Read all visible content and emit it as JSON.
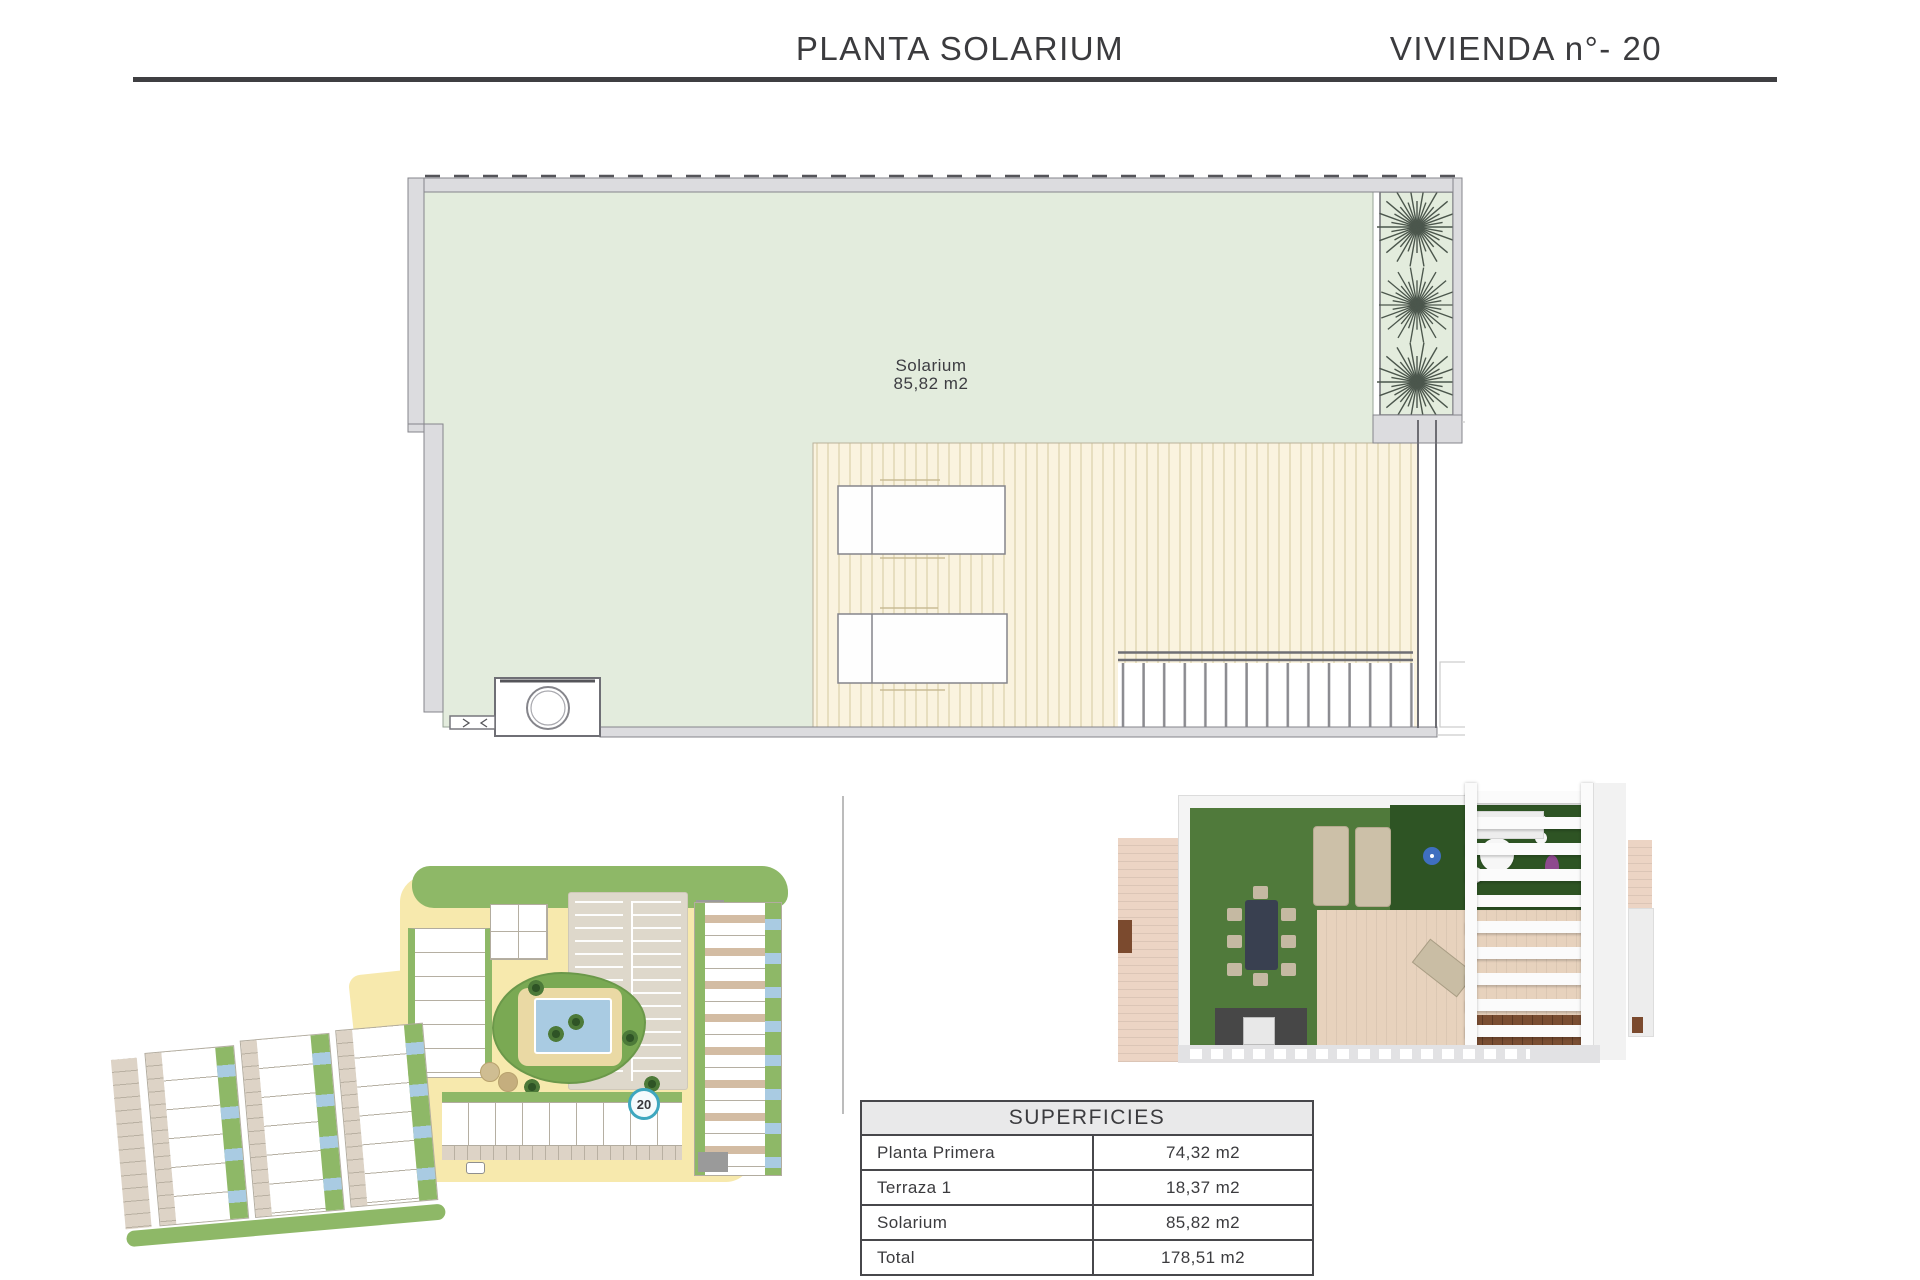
{
  "header": {
    "title_left": "PLANTA SOLARIUM",
    "title_right": "VIVIENDA n°- 20",
    "rule_color": "#3f3f42"
  },
  "floor_plan": {
    "room_label": {
      "name": "Solarium",
      "area": "85,82 m2"
    },
    "colors": {
      "solarium_green": "#e3ecdd",
      "deck_cream": "#faf3df",
      "deck_stripe": "#d9cfae",
      "wall_gray": "#dcdcdf"
    }
  },
  "site_plan": {
    "unit_marker": "20",
    "colors": {
      "road_yellow": "#f7e9ad",
      "grass_green": "#8eb867",
      "garden_green": "#7aa953",
      "pool_blue": "#a9cbe2",
      "paving": "#ded8cb",
      "marker_ring": "#3ea7bf"
    }
  },
  "render_3d": {
    "colors": {
      "turf": "#507a3b",
      "turf_dark": "#2e5424",
      "deck": "#e7d2bd",
      "side_deck": "#ecd4c4",
      "pergola": "#fbfbfb",
      "kitchen": "#474747",
      "dining_table": "#394050",
      "stair_wood": "#7a4e32"
    }
  },
  "surfaces_table": {
    "title": "SUPERFICIES",
    "rows": [
      {
        "label": "Planta Primera",
        "value": "74,32 m2"
      },
      {
        "label": "Terraza 1",
        "value": "18,37 m2"
      },
      {
        "label": "Solarium",
        "value": "85,82 m2"
      },
      {
        "label": "Total",
        "value": "178,51 m2"
      }
    ]
  }
}
